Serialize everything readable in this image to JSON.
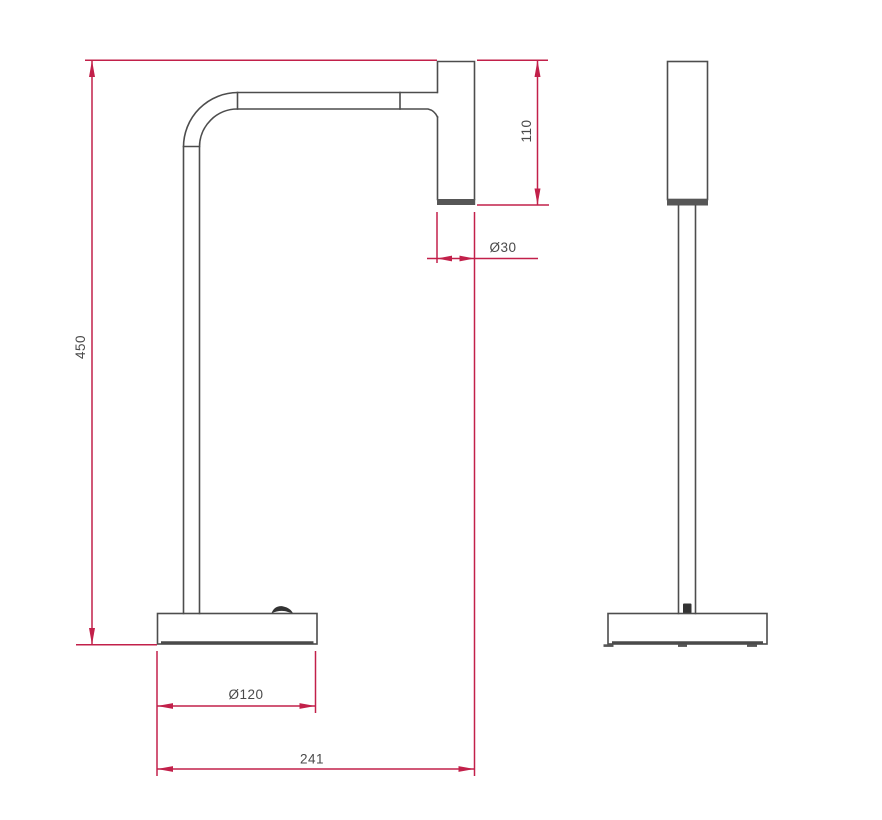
{
  "drawing": {
    "background": "#ffffff",
    "object_line_color": "#4d4d4d",
    "dimension_color": "#c2204a",
    "views": {
      "front": {
        "name": "front-view"
      },
      "side": {
        "name": "side-view"
      }
    },
    "dimensions": {
      "overall_height": {
        "label": "450",
        "orientation": "vertical"
      },
      "head_height": {
        "label": "110",
        "orientation": "vertical"
      },
      "head_diameter": {
        "label": "Ø30",
        "orientation": "horizontal"
      },
      "base_diameter": {
        "label": "Ø120",
        "orientation": "horizontal"
      },
      "overall_depth": {
        "label": "241",
        "orientation": "horizontal"
      }
    }
  }
}
